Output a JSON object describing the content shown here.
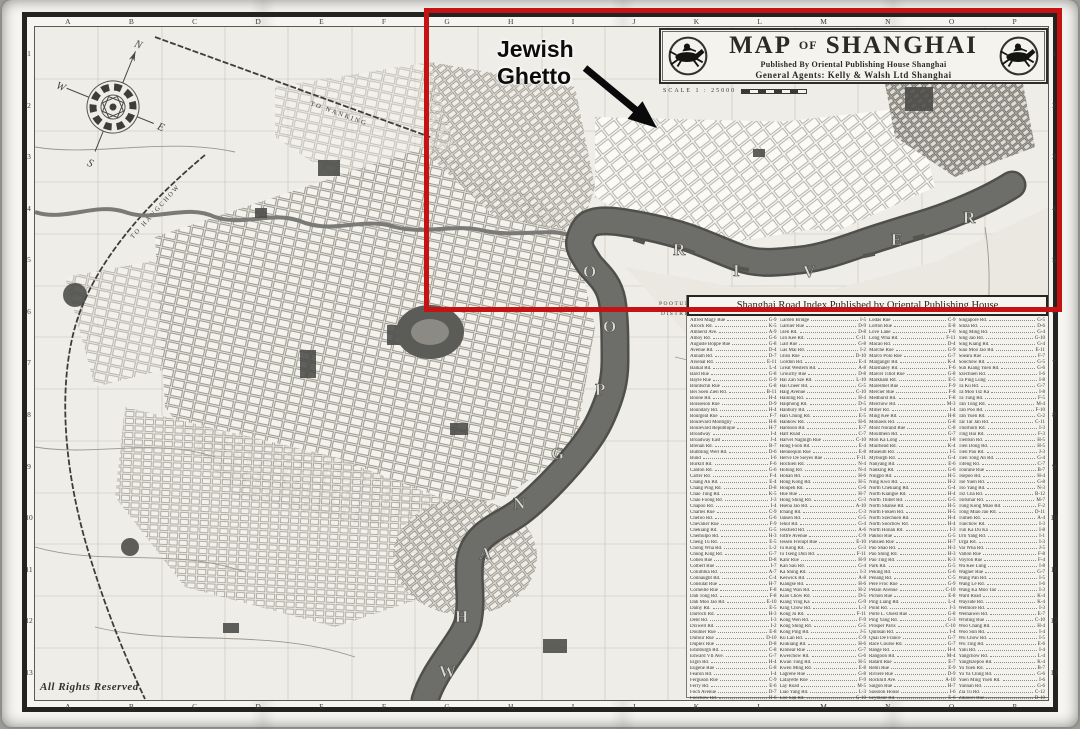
{
  "cartouche": {
    "title_map": "MAP",
    "title_of": "OF",
    "title_shanghai": "SHANGHAI",
    "publisher_line": "Published By Oriental Publishing House Shanghai",
    "agents_line": "General Agents: Kelly & Walsh Ltd Shanghai",
    "scale_label": "SCALE 1 : 25000",
    "logo": "jockey-horse-icon"
  },
  "annotation": {
    "label_line1": "Jewish",
    "label_line2": "Ghetto",
    "highlight_color": "#c41312"
  },
  "map_labels": {
    "to_nanking": "TO NANKING",
    "to_hangchow": "TO HANGCHOW",
    "pootung": "POOTUNG",
    "district": "DISTRICT",
    "rights_reserved": "All Rights Reserved",
    "river_letters_south": [
      "W",
      "H",
      "A",
      "N",
      "G",
      "P",
      "O",
      "O"
    ],
    "river_letters_east": [
      "R",
      "I",
      "V",
      "E",
      "R"
    ]
  },
  "frame": {
    "grid_columns": [
      "A",
      "B",
      "C",
      "D",
      "E",
      "F",
      "G",
      "H",
      "I",
      "J",
      "K",
      "L",
      "M",
      "N",
      "O",
      "P"
    ],
    "grid_rows": [
      "1",
      "2",
      "3",
      "4",
      "5",
      "6",
      "7",
      "8",
      "9",
      "10",
      "11",
      "12",
      "13"
    ]
  },
  "index": {
    "header": "Shanghai Road Index Published by Oriental Publishing House",
    "columns": [
      [
        [
          "Alfred Magy Rue",
          "G-9"
        ],
        [
          "Alcock Rd.",
          "K-5"
        ],
        [
          "Amherst Ave.",
          "A-9"
        ],
        [
          "Amoy Rd.",
          "G-6"
        ],
        [
          "Auguste Boppe Rue",
          "G-8"
        ],
        [
          "Avenue Rd.",
          "D-4"
        ],
        [
          "Annam Rd.",
          "D-7"
        ],
        [
          "Arsenal Rd.",
          "E-11"
        ],
        [
          "Baikal Rd.",
          "L-4"
        ],
        [
          "Bard Rue",
          "G-8"
        ],
        [
          "Bayle Rue",
          "G-9"
        ],
        [
          "Bluntschli Rue",
          "G-8"
        ],
        [
          "Bei Soen Zien Rd.",
          "B-11"
        ],
        [
          "Boone Rd.",
          "H-4"
        ],
        [
          "Boisseson Rue",
          "D-9"
        ],
        [
          "Boundary Rd.",
          "H-4"
        ],
        [
          "Bourgeat Rue",
          "F-7"
        ],
        [
          "Boulevard Montigny",
          "H-8"
        ],
        [
          "Boulevard Republique",
          "H-7"
        ],
        [
          "Broadway",
          "I-4"
        ],
        [
          "Broadway East",
          "J-4"
        ],
        [
          "Brenan Rd.",
          "B-7"
        ],
        [
          "Bubbling Well Rd.",
          "D-6"
        ],
        [
          "Bund",
          "I-6"
        ],
        [
          "Burkill Rd.",
          "F-6"
        ],
        [
          "Canton Rd.",
          "G-6"
        ],
        [
          "Carter Rd.",
          "F-4"
        ],
        [
          "Chang An Rd.",
          "E-4"
        ],
        [
          "Chang Ping Rd.",
          "D-8"
        ],
        [
          "Chao Tung Rd.",
          "K-5"
        ],
        [
          "Chao Foong Rd.",
          "J-3"
        ],
        [
          "Chapoo Rd.",
          "I-4"
        ],
        [
          "Charles Rue",
          "C-9"
        ],
        [
          "Chefoo Rd.",
          "G-6"
        ],
        [
          "Chevalier Rue",
          "F-9"
        ],
        [
          "Chekiang Rd.",
          "G-5"
        ],
        [
          "Chemulpo Rd.",
          "H-3"
        ],
        [
          "Cheng Tu Rd.",
          "E-5"
        ],
        [
          "Chong Wha Rd.",
          "L-2"
        ],
        [
          "Chung King Rd.",
          "G-7"
        ],
        [
          "Cohen Rue",
          "D-8"
        ],
        [
          "Colbert Rue",
          "I-7"
        ],
        [
          "Columbia Rd.",
          "A-7"
        ],
        [
          "Connaught Rd.",
          "C-4"
        ],
        [
          "Consulat Rue",
          "H-7"
        ],
        [
          "Corneille Rue",
          "F-8"
        ],
        [
          "Dah Tong Rd.",
          "F-8"
        ],
        [
          "Dah Moo Jao Rd.",
          "E-10"
        ],
        [
          "Dalny Rd.",
          "E-5"
        ],
        [
          "Darroch Rd.",
          "H-3"
        ],
        [
          "Dent Rd.",
          "I-3"
        ],
        [
          "Dixwell Rd.",
          "I-2"
        ],
        [
          "Doumer Rue",
          "E-8"
        ],
        [
          "Dufour Rue",
          "D-10"
        ],
        [
          "Duplex Rue",
          "D-8"
        ],
        [
          "Edinburgh Rd.",
          "C-8"
        ],
        [
          "Edward VII Ave.",
          "G-7"
        ],
        [
          "Elgin Rd.",
          "H-4"
        ],
        [
          "Eugene Rue",
          "G-8"
        ],
        [
          "Fearon Rd.",
          "I-4"
        ],
        [
          "Ferguson Rue",
          "C-9"
        ],
        [
          "Ferry Rd.",
          "E-6"
        ],
        [
          "Foch Avenue",
          "D-7"
        ],
        [
          "Foochow Rd.",
          "H-6"
        ]
      ],
      [
        [
          "Garden Bridge",
          "I-5"
        ],
        [
          "Garnier Rue",
          "D-9"
        ],
        [
          "Glen Rd.",
          "D-8"
        ],
        [
          "Gin Kee Rd.",
          "C-11"
        ],
        [
          "Gall Rue",
          "G-8"
        ],
        [
          "Gas Mai Rd.",
          "I-2"
        ],
        [
          "Ghisi Rue",
          "D-10"
        ],
        [
          "Gordon Rd.",
          "E-4"
        ],
        [
          "Great Western Rd.",
          "A-8"
        ],
        [
          "Grouchy Rue",
          "D-8"
        ],
        [
          "Hai Zan Sze Rd.",
          "L-10"
        ],
        [
          "Hai Cheer Rd.",
          "G-5"
        ],
        [
          "Haig Avenue",
          "C-10"
        ],
        [
          "Haining Rd.",
          "H-4"
        ],
        [
          "Haiphong Rd.",
          "D-5"
        ],
        [
          "Hanbury Rd.",
          "I-4"
        ],
        [
          "Han Chung Rd.",
          "E-5"
        ],
        [
          "Hankow Rd.",
          "H-6"
        ],
        [
          "Hardoon Rd.",
          "E-7"
        ],
        [
          "Hart Road",
          "C-7"
        ],
        [
          "Harvel Nagnigh Rue",
          "C-10"
        ],
        [
          "Hong Foon Rd.",
          "E-4"
        ],
        [
          "Hennequin Rue",
          "E-8"
        ],
        [
          "Herve De Sieyes Rue",
          "F-11"
        ],
        [
          "Hochien Rd.",
          "N-4"
        ],
        [
          "Holung Rd.",
          "N-4"
        ],
        [
          "Honan Rd.",
          "H-6"
        ],
        [
          "Hong Kong Rd.",
          "H-5"
        ],
        [
          "Houpeh Rd.",
          "G-6"
        ],
        [
          "Hue Rue",
          "H-7"
        ],
        [
          "Hong Shing Rd.",
          "G-3"
        ],
        [
          "Hsena Jao Rd.",
          "A-10"
        ],
        [
          "Ichang Rd.",
          "C-3"
        ],
        [
          "Jansen Rd.",
          "G-5"
        ],
        [
          "Jehol Rd.",
          "G-4"
        ],
        [
          "Jessfield Rd.",
          "A-6"
        ],
        [
          "Joffre Avenue",
          "C-9"
        ],
        [
          "Jessen Frelupt Rue",
          "E-10"
        ],
        [
          "Ju Kong Rd.",
          "G-3"
        ],
        [
          "Ju Tseng Dun Rd.",
          "F-11"
        ],
        [
          "Kahr Rue",
          "H-9"
        ],
        [
          "Kan Sau Rd.",
          "G-4"
        ],
        [
          "Ka Shing Rd.",
          "I-3"
        ],
        [
          "Keswick Rd.",
          "A-8"
        ],
        [
          "Kiangse Rd.",
          "H-6"
        ],
        [
          "Kiang Wan Rd.",
          "H-2"
        ],
        [
          "Kiao Chow Rd.",
          "D-5"
        ],
        [
          "Kiang Ying Ka",
          "G-9"
        ],
        [
          "King Chow Rd.",
          "L-3"
        ],
        [
          "Kong Ju Rd.",
          "F-11"
        ],
        [
          "Kong Wen Rd.",
          "F-9"
        ],
        [
          "Kong Shing Rd.",
          "G-5"
        ],
        [
          "Kong Ping Rd.",
          "J-5"
        ],
        [
          "Ku Lan Rd.",
          "C-9"
        ],
        [
          "Kiukiang Rd.",
          "H-6"
        ],
        [
          "Kinnear Rue",
          "G-7"
        ],
        [
          "Kweichow Rd.",
          "G-6"
        ],
        [
          "Kwan Tung Rd.",
          "H-5"
        ],
        [
          "Kwen Ming Rd.",
          "E-8"
        ],
        [
          "Lagrene Rue",
          "G-8"
        ],
        [
          "Lafayette Rue",
          "F-9"
        ],
        [
          "Lay Road",
          "M-5"
        ],
        [
          "Liao Yang Rd.",
          "L-3"
        ],
        [
          "Loo San Rd.",
          "G-10"
        ]
      ],
      [
        [
          "Lodas Rue",
          "C-9"
        ],
        [
          "Lorton Rue",
          "E-8"
        ],
        [
          "Love Lane",
          "F-6"
        ],
        [
          "Long Wha Rd.",
          "F-11"
        ],
        [
          "Macao Rd.",
          "D-4"
        ],
        [
          "Marche Rue",
          "G-9"
        ],
        [
          "Marco Polo Rue",
          "G-7"
        ],
        [
          "Margangir Rd.",
          "K-4"
        ],
        [
          "Marshaley Rd.",
          "F-6"
        ],
        [
          "Marcel Tillot Rue",
          "G-8"
        ],
        [
          "Markham Rd.",
          "E-5"
        ],
        [
          "Maresmel Rue",
          "F-9"
        ],
        [
          "Mercier Rue",
          "F-8"
        ],
        [
          "Medhurst Rd.",
          "F-8"
        ],
        [
          "Meichow Rd.",
          "M-3"
        ],
        [
          "Miller Rd.",
          "I-4"
        ],
        [
          "Ming Kee Rd.",
          "H-8"
        ],
        [
          "Mohawk Rd.",
          "G-8"
        ],
        [
          "Mont Norand Rue",
          "C-8"
        ],
        [
          "Moulmein Rd.",
          "G-7"
        ],
        [
          "Mon Ka Long",
          "I-8"
        ],
        [
          "Muirhead Rd.",
          "K-4"
        ],
        [
          "Museum Rd.",
          "I-5"
        ],
        [
          "Myburgh Rd.",
          "G-4"
        ],
        [
          "Nanyang Rd.",
          "E-6"
        ],
        [
          "Nanking Rd.",
          "G-6"
        ],
        [
          "Ningpo Rd.",
          "H-5"
        ],
        [
          "Ning Kwo Rd.",
          "H-2"
        ],
        [
          "North Chekiang Rd.",
          "G-4"
        ],
        [
          "North Kiangse Rd.",
          "H-4"
        ],
        [
          "North Thibet Rd.",
          "G-5"
        ],
        [
          "North Shanse Rd.",
          "H-5"
        ],
        [
          "North Fokien Rd.",
          "H-5"
        ],
        [
          "North Szechuen Rd.",
          "H-4"
        ],
        [
          "North Soochow Rd.",
          "H-4"
        ],
        [
          "North Honan Rd.",
          "I-3"
        ],
        [
          "Pakhoi Rue",
          "G-5"
        ],
        [
          "Pahsien Rue",
          "H-7"
        ],
        [
          "Pao Shao Rd.",
          "H-3"
        ],
        [
          "Pao Shing Rd.",
          "H-3"
        ],
        [
          "Pao Ting Rd.",
          "K-3"
        ],
        [
          "Park Rd.",
          "G-5"
        ],
        [
          "Peking Rd.",
          "G-6"
        ],
        [
          "Penang Rd.",
          "C-5"
        ],
        [
          "Pere Froc Rue",
          "G-9"
        ],
        [
          "Petain Avenue",
          "C-10"
        ],
        [
          "Pichon Rue",
          "E-8"
        ],
        [
          "Ping Liang Rd.",
          "L-4"
        ],
        [
          "Point Rd.",
          "J-3"
        ],
        [
          "Porte L. Ouest Rue",
          "G-8"
        ],
        [
          "Ping Yang Rd.",
          "G-3"
        ],
        [
          "Prosper Paris",
          "C-10"
        ],
        [
          "Quinsan Rd.",
          "I-4"
        ],
        [
          "Quai De France",
          "G-7"
        ],
        [
          "Race Course Rd.",
          "G-7"
        ],
        [
          "Range Rd.",
          "H-4"
        ],
        [
          "Rangoon Rd.",
          "M-4"
        ],
        [
          "Ratard Rue",
          "E-7"
        ],
        [
          "Remi Rue",
          "E-9"
        ],
        [
          "Riviere Rue",
          "D-9"
        ],
        [
          "Rockhill Ave.",
          "A-10"
        ],
        [
          "Saigon Rue",
          "H-7"
        ],
        [
          "Sassoon House",
          "I-6"
        ],
        [
          "Seymour Rd.",
          "E-6"
        ]
      ],
      [
        [
          "Singapore Rd.",
          "G-5"
        ],
        [
          "Sinza Rd.",
          "D-6"
        ],
        [
          "Sing Ming Rd.",
          "G-4"
        ],
        [
          "Sing Jao Rd.",
          "G-10"
        ],
        [
          "Sing Kiang Rd.",
          "G-4"
        ],
        [
          "Siao Moo Jao Rd.",
          "E-11"
        ],
        [
          "Soeara Rue",
          "F-7"
        ],
        [
          "Soochow Rd.",
          "G-5"
        ],
        [
          "Sun Kiang Yuen Rd.",
          "G-6"
        ],
        [
          "Szechuen Rd.",
          "I-6"
        ],
        [
          "Ta Ping Lung",
          "I-8"
        ],
        [
          "Ta Ku Rd.",
          "G-7"
        ],
        [
          "Ta Moo Tsz Ka",
          "I-8"
        ],
        [
          "Ta Tung Rd.",
          "F-5"
        ],
        [
          "Tan Tung Rd.",
          "M-4"
        ],
        [
          "Tan Poo Rd.",
          "F-10"
        ],
        [
          "Tan Yuen Rd.",
          "G-2"
        ],
        [
          "Tar Tar Jan Rd.",
          "C-11"
        ],
        [
          "Thorburn Rd.",
          "I-3"
        ],
        [
          "Ting Hai Rd.",
          "F-3"
        ],
        [
          "Tientsin Rd.",
          "H-5"
        ],
        [
          "Tien Dong Rd.",
          "H-5"
        ],
        [
          "Tien Pao Rd.",
          "J-3"
        ],
        [
          "Tien Tong An Rd.",
          "G-4"
        ],
        [
          "Tifeng Rd.",
          "C-7"
        ],
        [
          "Tourane Rue",
          "B-7"
        ],
        [
          "Tsepoo Rd.",
          "H-4"
        ],
        [
          "Tse Yuen Rd.",
          "G-8"
        ],
        [
          "Tso Yang Rd.",
          "N-3"
        ],
        [
          "Tsz Cha Rd.",
          "B-12"
        ],
        [
          "Tsitsihar Rd.",
          "M-7"
        ],
        [
          "Tung Kong Miao Rd.",
          "F-2"
        ],
        [
          "Tong Miao Jao Rd.",
          "D-11"
        ],
        [
          "Tumen Rd.",
          "A-4"
        ],
        [
          "Tunchow Rd.",
          "I-3"
        ],
        [
          "Tun Ka Du Ka",
          "I-8"
        ],
        [
          "Urn Yang Rd.",
          "I-1"
        ],
        [
          "Urga Rd.",
          "I-3"
        ],
        [
          "Vai Wha Rd.",
          "J-5"
        ],
        [
          "Vallon Rue",
          "F-8"
        ],
        [
          "Voyron Rue",
          "F-4"
        ],
        [
          "Wa Kee Lung",
          "I-8"
        ],
        [
          "Wagner Rue",
          "G-7"
        ],
        [
          "Wang Pan Rd.",
          "I-5"
        ],
        [
          "Wang Le Rd.",
          "I-6"
        ],
        [
          "Wang Ka Moo Tao",
          "I-3"
        ],
        [
          "Ward Road",
          "K-4"
        ],
        [
          "Wayside Rd.",
          "K-4"
        ],
        [
          "Wetmore Rd.",
          "I-3"
        ],
        [
          "Weihaiwei Rd.",
          "E-7"
        ],
        [
          "Whiting Rue",
          "C-10"
        ],
        [
          "Woo Chang Rd.",
          "H-4"
        ],
        [
          "Woo Sun Rd.",
          "I-4"
        ],
        [
          "Wu Chow Rd.",
          "I-5"
        ],
        [
          "Wu Ting Rd.",
          "E-6"
        ],
        [
          "Yalu Rd.",
          "I-4"
        ],
        [
          "Yangchow Rd.",
          "L-4"
        ],
        [
          "Yangtszepoo Rd.",
          "K-4"
        ],
        [
          "Yu Yuen Rd.",
          "B-7"
        ],
        [
          "Yu Ya Ching Rd.",
          "G-6"
        ],
        [
          "Yuen Ming Yuen Rd.",
          "I-6"
        ],
        [
          "Yunnan Rd.",
          "G-6"
        ],
        [
          "Zia Tu Rd.",
          "C-12"
        ],
        [
          "Zikawei Rue",
          "D-10"
        ]
      ]
    ]
  }
}
